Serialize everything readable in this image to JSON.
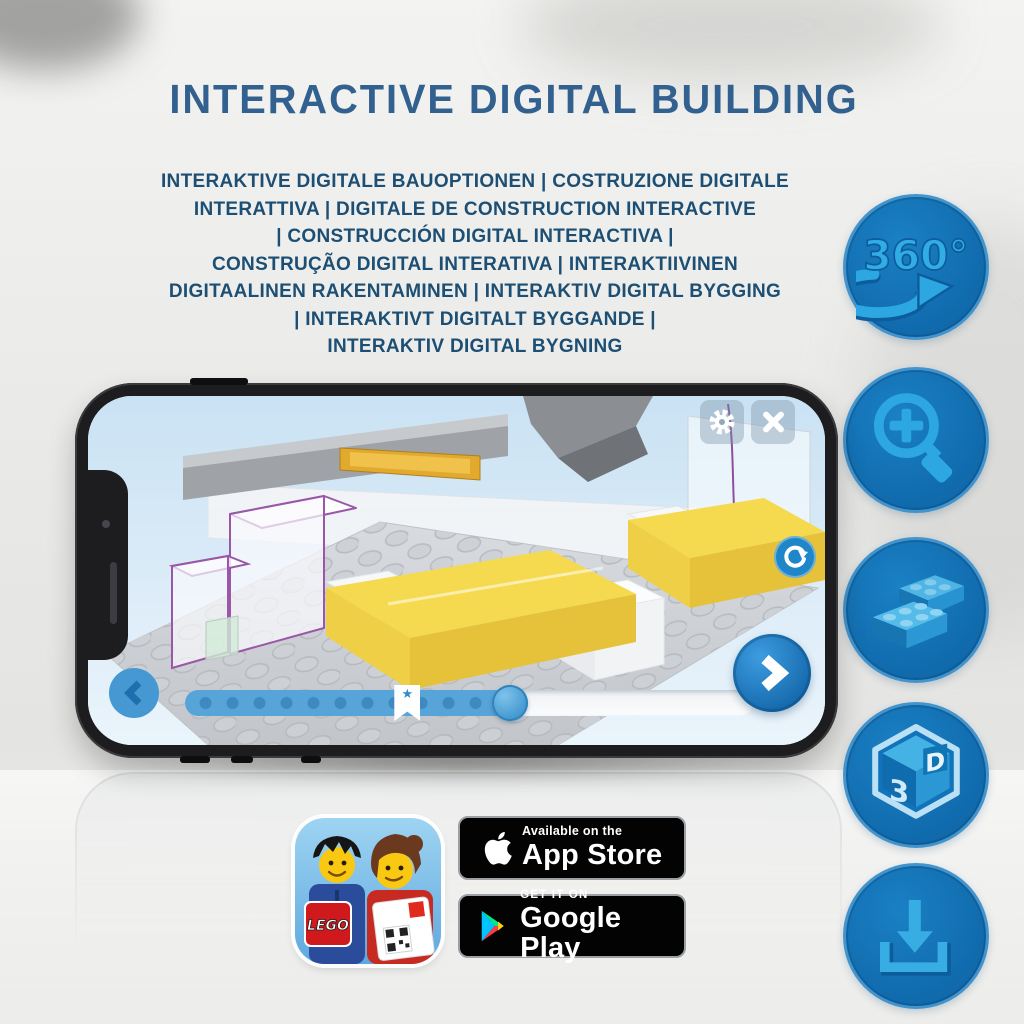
{
  "header": {
    "title": "INTERACTIVE DIGITAL BUILDING",
    "subtitle_lines": [
      "INTERAKTIVE DIGITALE BAUOPTIONEN | COSTRUZIONE DIGITALE",
      "INTERATTIVA | DIGITALE DE CONSTRUCTION INTERACTIVE",
      "| CONSTRUCCIÓN DIGITAL INTERACTIVA |",
      "CONSTRUÇÃO DIGITAL INTERATIVA | INTERAKTIIVINEN",
      "DIGITAALINEN RAKENTAMINEN | INTERAKTIV DIGITAL BYGGING",
      "| INTERAKTIVT DIGITALT BYGGANDE |",
      "INTERAKTIV DIGITAL BYGNING"
    ]
  },
  "features": [
    {
      "id": "rotate-360",
      "icon": "360-rotation-icon",
      "label": "360°"
    },
    {
      "id": "zoom-in",
      "icon": "zoom-in-magnifier-icon"
    },
    {
      "id": "brick-options",
      "icon": "lego-bricks-icon"
    },
    {
      "id": "view-3d",
      "icon": "3d-cube-icon",
      "digit": "3",
      "letter": "D"
    },
    {
      "id": "download",
      "icon": "download-icon"
    }
  ],
  "phone_app": {
    "progress": {
      "percent": 57,
      "bookmark_percent": 39
    },
    "buttons": [
      "settings-gear",
      "close",
      "rotate-view",
      "next-step",
      "previous-step"
    ]
  },
  "app_icon": {
    "lego_logo_text": "LEGO"
  },
  "store_badges": {
    "app_store": {
      "tagline": "Available on the",
      "store_name": "App Store"
    },
    "google_play": {
      "tagline": "GET IT ON",
      "store_name": "Google Play"
    }
  },
  "colors": {
    "title_blue": "#33618f",
    "subtitle_blue": "#1d4f74",
    "feature_circle_blue": "#1173b9",
    "feature_glyph_blue": "#2da7e2",
    "app_ui_blue": "#2f8fd0",
    "bed_yellow": "#f5d94f",
    "ghost_outline_purple": "#9a57a8",
    "badge_black": "#030303"
  }
}
